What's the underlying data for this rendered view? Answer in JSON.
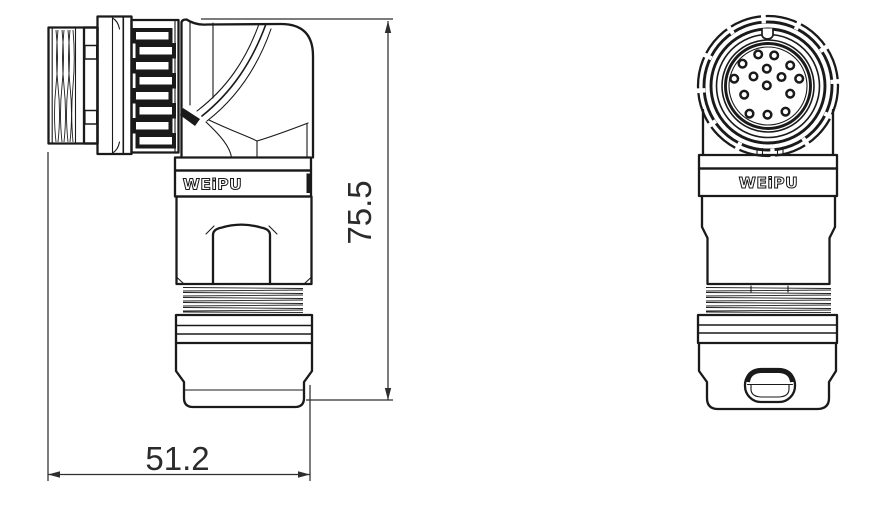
{
  "drawing": {
    "brand": "WEIPU",
    "subject": "right-angle circular connector, two-view outline drawing",
    "views": [
      "side view",
      "front view"
    ]
  },
  "side_view": {
    "brand_label": "WEiPU"
  },
  "front_view": {
    "brand_label": "WEiPU",
    "pin_count": 15,
    "center": [
      768,
      86
    ],
    "pin_radius": 3.8,
    "pins": [
      [
        -9.8,
        -31.6
      ],
      [
        6.2,
        -30.6
      ],
      [
        -25.5,
        -22.3
      ],
      [
        22.2,
        -20.6
      ],
      [
        -1.2,
        -17.3
      ],
      [
        -33.8,
        -7.3
      ],
      [
        -14.5,
        -9.6
      ],
      [
        13.5,
        -9.0
      ],
      [
        31.2,
        -7.3
      ],
      [
        -1.2,
        -0.6
      ],
      [
        -23.8,
        8.7
      ],
      [
        22.2,
        7.7
      ],
      [
        -18.5,
        27.7
      ],
      [
        -0.5,
        28.7
      ],
      [
        17.5,
        25.7
      ]
    ]
  },
  "dimensions": {
    "width": {
      "label": "51.2"
    },
    "height": {
      "label": "75.5"
    }
  },
  "colors": {
    "line": "#1a1a1a",
    "dimension": "#2e2e2e",
    "background": "#ffffff"
  }
}
